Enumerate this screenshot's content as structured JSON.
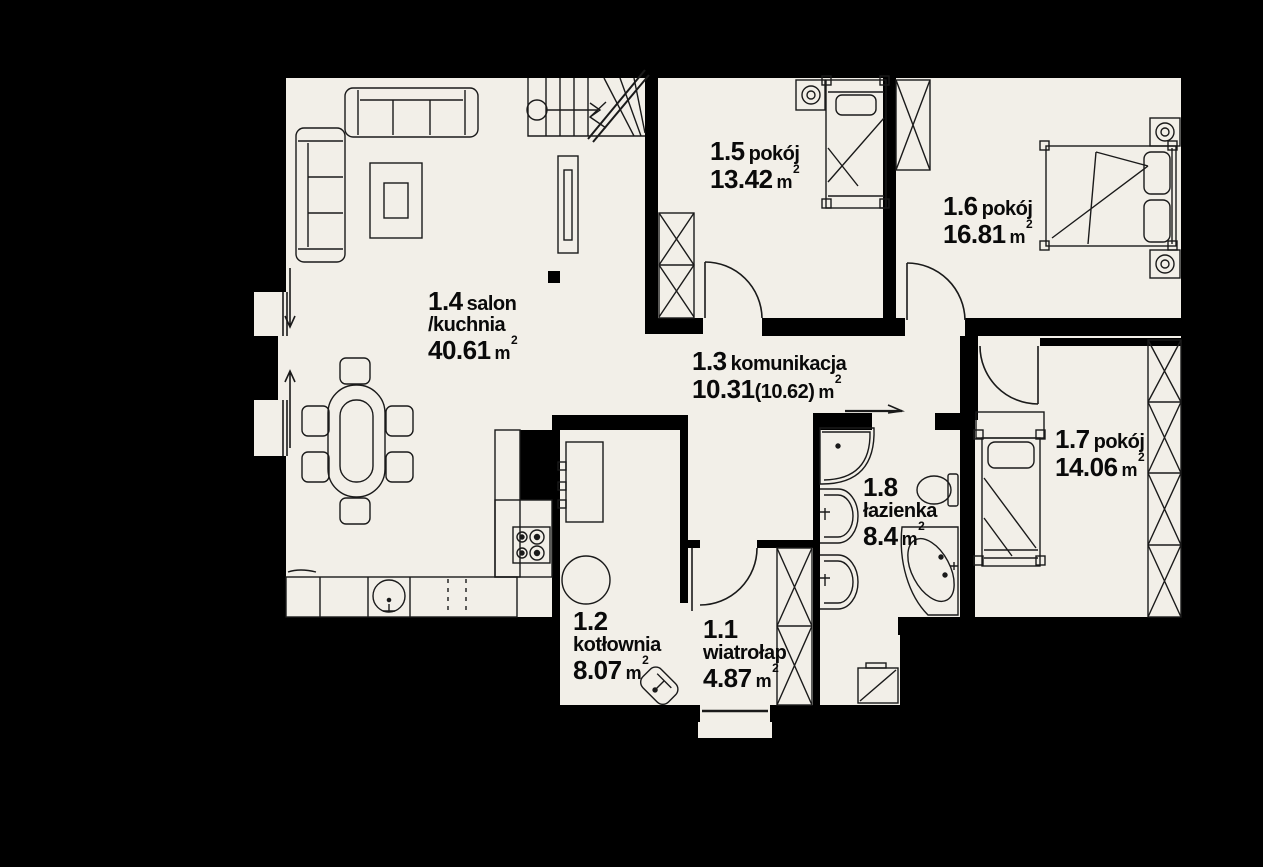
{
  "title": "first floor plan",
  "colors": {
    "background": "#000000",
    "floor": "#f2efe8",
    "wall": "#000000",
    "line": "#1a1a1a"
  },
  "rooms": [
    {
      "id": "1.1",
      "name": "wiatrołap",
      "area": "4.87",
      "unit": "m",
      "sup": "2"
    },
    {
      "id": "1.2",
      "name": "kotłownia",
      "area": "8.07",
      "unit": "m",
      "sup": "2"
    },
    {
      "id": "1.3",
      "name": "komunikacja",
      "area": "10.31",
      "area_alt": "(10.62)",
      "unit": "m",
      "sup": "2"
    },
    {
      "id": "1.4",
      "name": "salon",
      "name2": "/kuchnia",
      "area": "40.61",
      "unit": "m",
      "sup": "2"
    },
    {
      "id": "1.5",
      "name": "pokój",
      "area": "13.42",
      "unit": "m",
      "sup": "2"
    },
    {
      "id": "1.6",
      "name": "pokój",
      "area": "16.81",
      "unit": "m",
      "sup": "2"
    },
    {
      "id": "1.7",
      "name": "pokój",
      "area": "14.06",
      "unit": "m",
      "sup": "2"
    },
    {
      "id": "1.8",
      "name": "łazienka",
      "area": "8.4",
      "unit": "m",
      "sup": "2"
    }
  ],
  "furniture": [
    "stairs",
    "radiator",
    "corner-sofa",
    "coffee-table",
    "dining-table",
    "chairs",
    "kitchen-counter",
    "kitchen-sink",
    "stove",
    "chimney",
    "boiler",
    "water-tank",
    "corner-washbasin",
    "wardrobe",
    "single-bed",
    "double-bed",
    "nightstand-lamp",
    "shower",
    "washbasin",
    "toilet",
    "corner-bathtub",
    "washing-machine"
  ]
}
